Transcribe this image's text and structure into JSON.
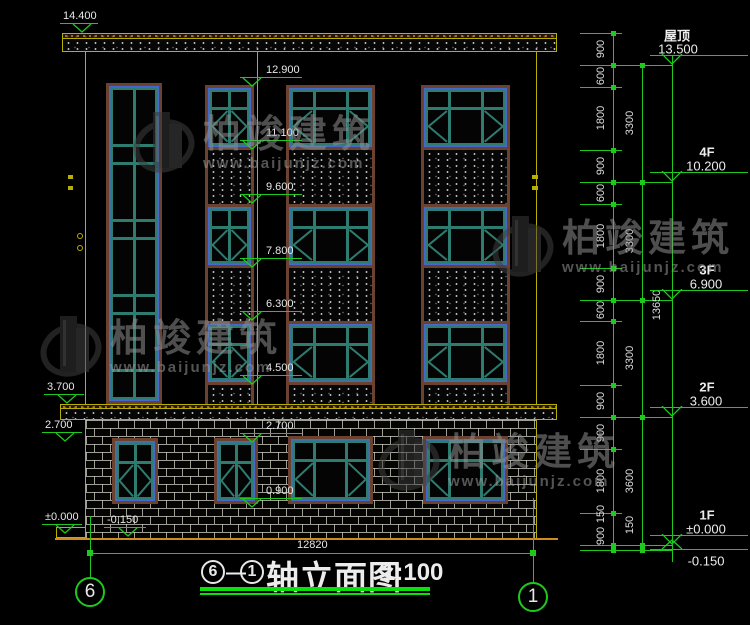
{
  "drawing": {
    "type": "elevation",
    "bottom_dim": "12820"
  },
  "title": {
    "axis_left": "6",
    "dash": "—",
    "axis_right": "1",
    "name": "轴立面图",
    "scale": "1:100"
  },
  "axis_bubbles": {
    "left": "6",
    "right": "1"
  },
  "markers": {
    "left": [
      "14.400",
      "3.700",
      "2.700",
      "±0.000",
      "-0.150"
    ],
    "mid": [
      "12.900",
      "11.100",
      "9.600",
      "7.800",
      "6.300",
      "4.500",
      "2.700",
      "0.900"
    ]
  },
  "right_chain": {
    "col1": [
      "900",
      "600",
      "1800",
      "900",
      "600",
      "1800",
      "900",
      "600",
      "1800",
      "900",
      "900",
      "1800",
      "900",
      "150"
    ],
    "col2": [
      "3300",
      "3300",
      "3300",
      "3600",
      "150"
    ],
    "total": "13650",
    "floors": [
      {
        "name": "屋顶",
        "elev": "13.500"
      },
      {
        "name": "4F",
        "elev": "10.200"
      },
      {
        "name": "3F",
        "elev": "6.900"
      },
      {
        "name": "2F",
        "elev": "3.600"
      },
      {
        "name": "1F",
        "elev": "±0.000"
      },
      {
        "name": "",
        "elev": "-0.150"
      }
    ]
  },
  "watermark": {
    "brand": "柏竣建筑",
    "url": "www.baijunjz.com"
  },
  "colors": {
    "dim_green": "#1ec91e",
    "line_yellow": "#b8b000",
    "ground_orange": "#cf8c1e",
    "frame_teal": "#2e7b70",
    "glass_blue": "#4866d4",
    "surround_brown": "#6b4230",
    "text_white": "#e8e8e8"
  }
}
